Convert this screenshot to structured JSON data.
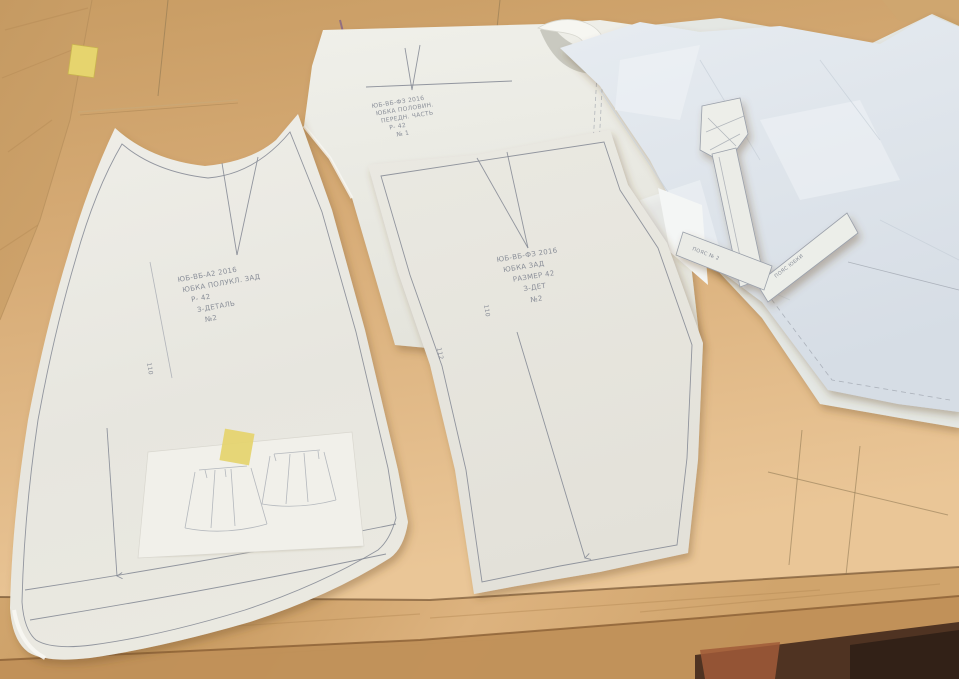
{
  "scene": {
    "type": "photograph",
    "subject": "Hand-drafted sewing paper pattern pieces for a skirt laid over brown kraft paper on a light wooden table",
    "colors": {
      "wood": "#cda26b",
      "wood_light": "#e0b886",
      "wood_front_edge": "#bd8b55",
      "kraft": "#d4a771",
      "kraft_light": "#eac697",
      "pattern_paper": "#eae9e3",
      "cool_sheet": "#dde3e9",
      "pencil": "#7b818c",
      "masking_tape": "#e3d26b",
      "under_table_dark": "#4f3322",
      "under_table_red": "#a05a38"
    }
  },
  "patterns": {
    "left_front": {
      "piece": "skirt panel pattern with curved waist, dart, hem lines and grainline arrow",
      "annotation_lines": [
        "ЮБ-ВБ-А2 2016",
        "ЮБКА ПОЛУКЛ. ЗАД",
        "Р- 42",
        "З-ДЕТАЛЬ",
        "№2"
      ],
      "side_label": "110"
    },
    "center_front": {
      "piece": "skirt panel pattern with top dart and grainline arrow",
      "annotation_lines": [
        "ЮБ-ВБ-ФЗ 2016",
        "ЮБКА ЗАД",
        "РАЗМЕР 42",
        "З-ДЕТ",
        "№2"
      ],
      "side_labels": [
        "110",
        "112"
      ]
    },
    "back_sheet": {
      "piece": "pattern sheet behind, with dart, drafting lines and curled corner",
      "annotation_lines": [
        "ЮБ-ВБ-ФЗ 2016",
        "ЮБКА ПОЛОВИН.",
        "ПЕРЕДН. ЧАСТЬ",
        "Р- 42",
        "№ 1"
      ]
    },
    "waistband_strips": {
      "piece": "narrow waistband pattern strips fanned on the right sheets",
      "labels": [
        "ПОЯС ЮБКИ",
        "ПОЯС № 2"
      ]
    }
  }
}
